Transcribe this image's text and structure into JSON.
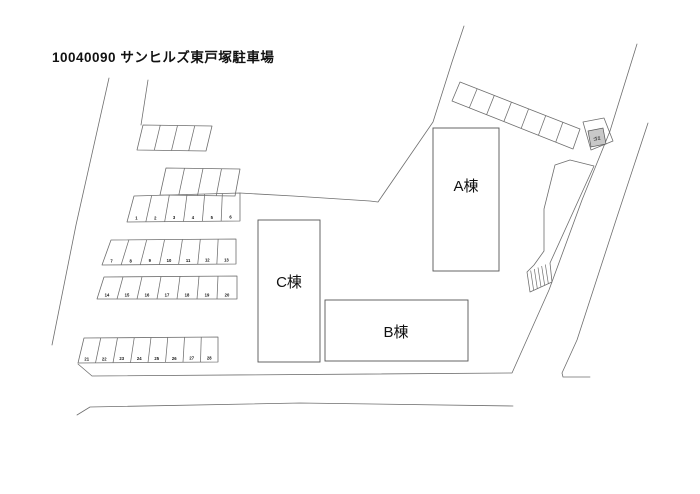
{
  "title": "10040090 サンヒルズ東戸塚駐車場",
  "buildings": [
    {
      "label": "A棟"
    },
    {
      "label": "B棟"
    },
    {
      "label": "C棟"
    }
  ],
  "parking_rows": [
    {
      "id": "1-6",
      "numbers": [
        "1",
        "2",
        "3",
        "4",
        "5",
        "6"
      ]
    },
    {
      "id": "7-13",
      "numbers": [
        "7",
        "8",
        "9",
        "10",
        "11",
        "12",
        "13"
      ]
    },
    {
      "id": "14-20",
      "numbers": [
        "14",
        "15",
        "16",
        "17",
        "18",
        "19",
        "20"
      ]
    },
    {
      "id": "21-28",
      "numbers": [
        "21",
        "22",
        "23",
        "24",
        "25",
        "26",
        "27",
        "28"
      ]
    }
  ],
  "unnumbered_rows": [
    {
      "id": "upper-left-block",
      "cells": 4
    },
    {
      "id": "upper-mid-row",
      "cells": 4
    },
    {
      "id": "top-right-strip",
      "cells": 7
    }
  ],
  "annotations": {
    "trash_label": "ゴミ"
  },
  "colors": {
    "line": "#6e6e6e",
    "building_outline": "#565656",
    "text": "#111111",
    "shade": "#c8c8c8",
    "background": "#ffffff"
  }
}
